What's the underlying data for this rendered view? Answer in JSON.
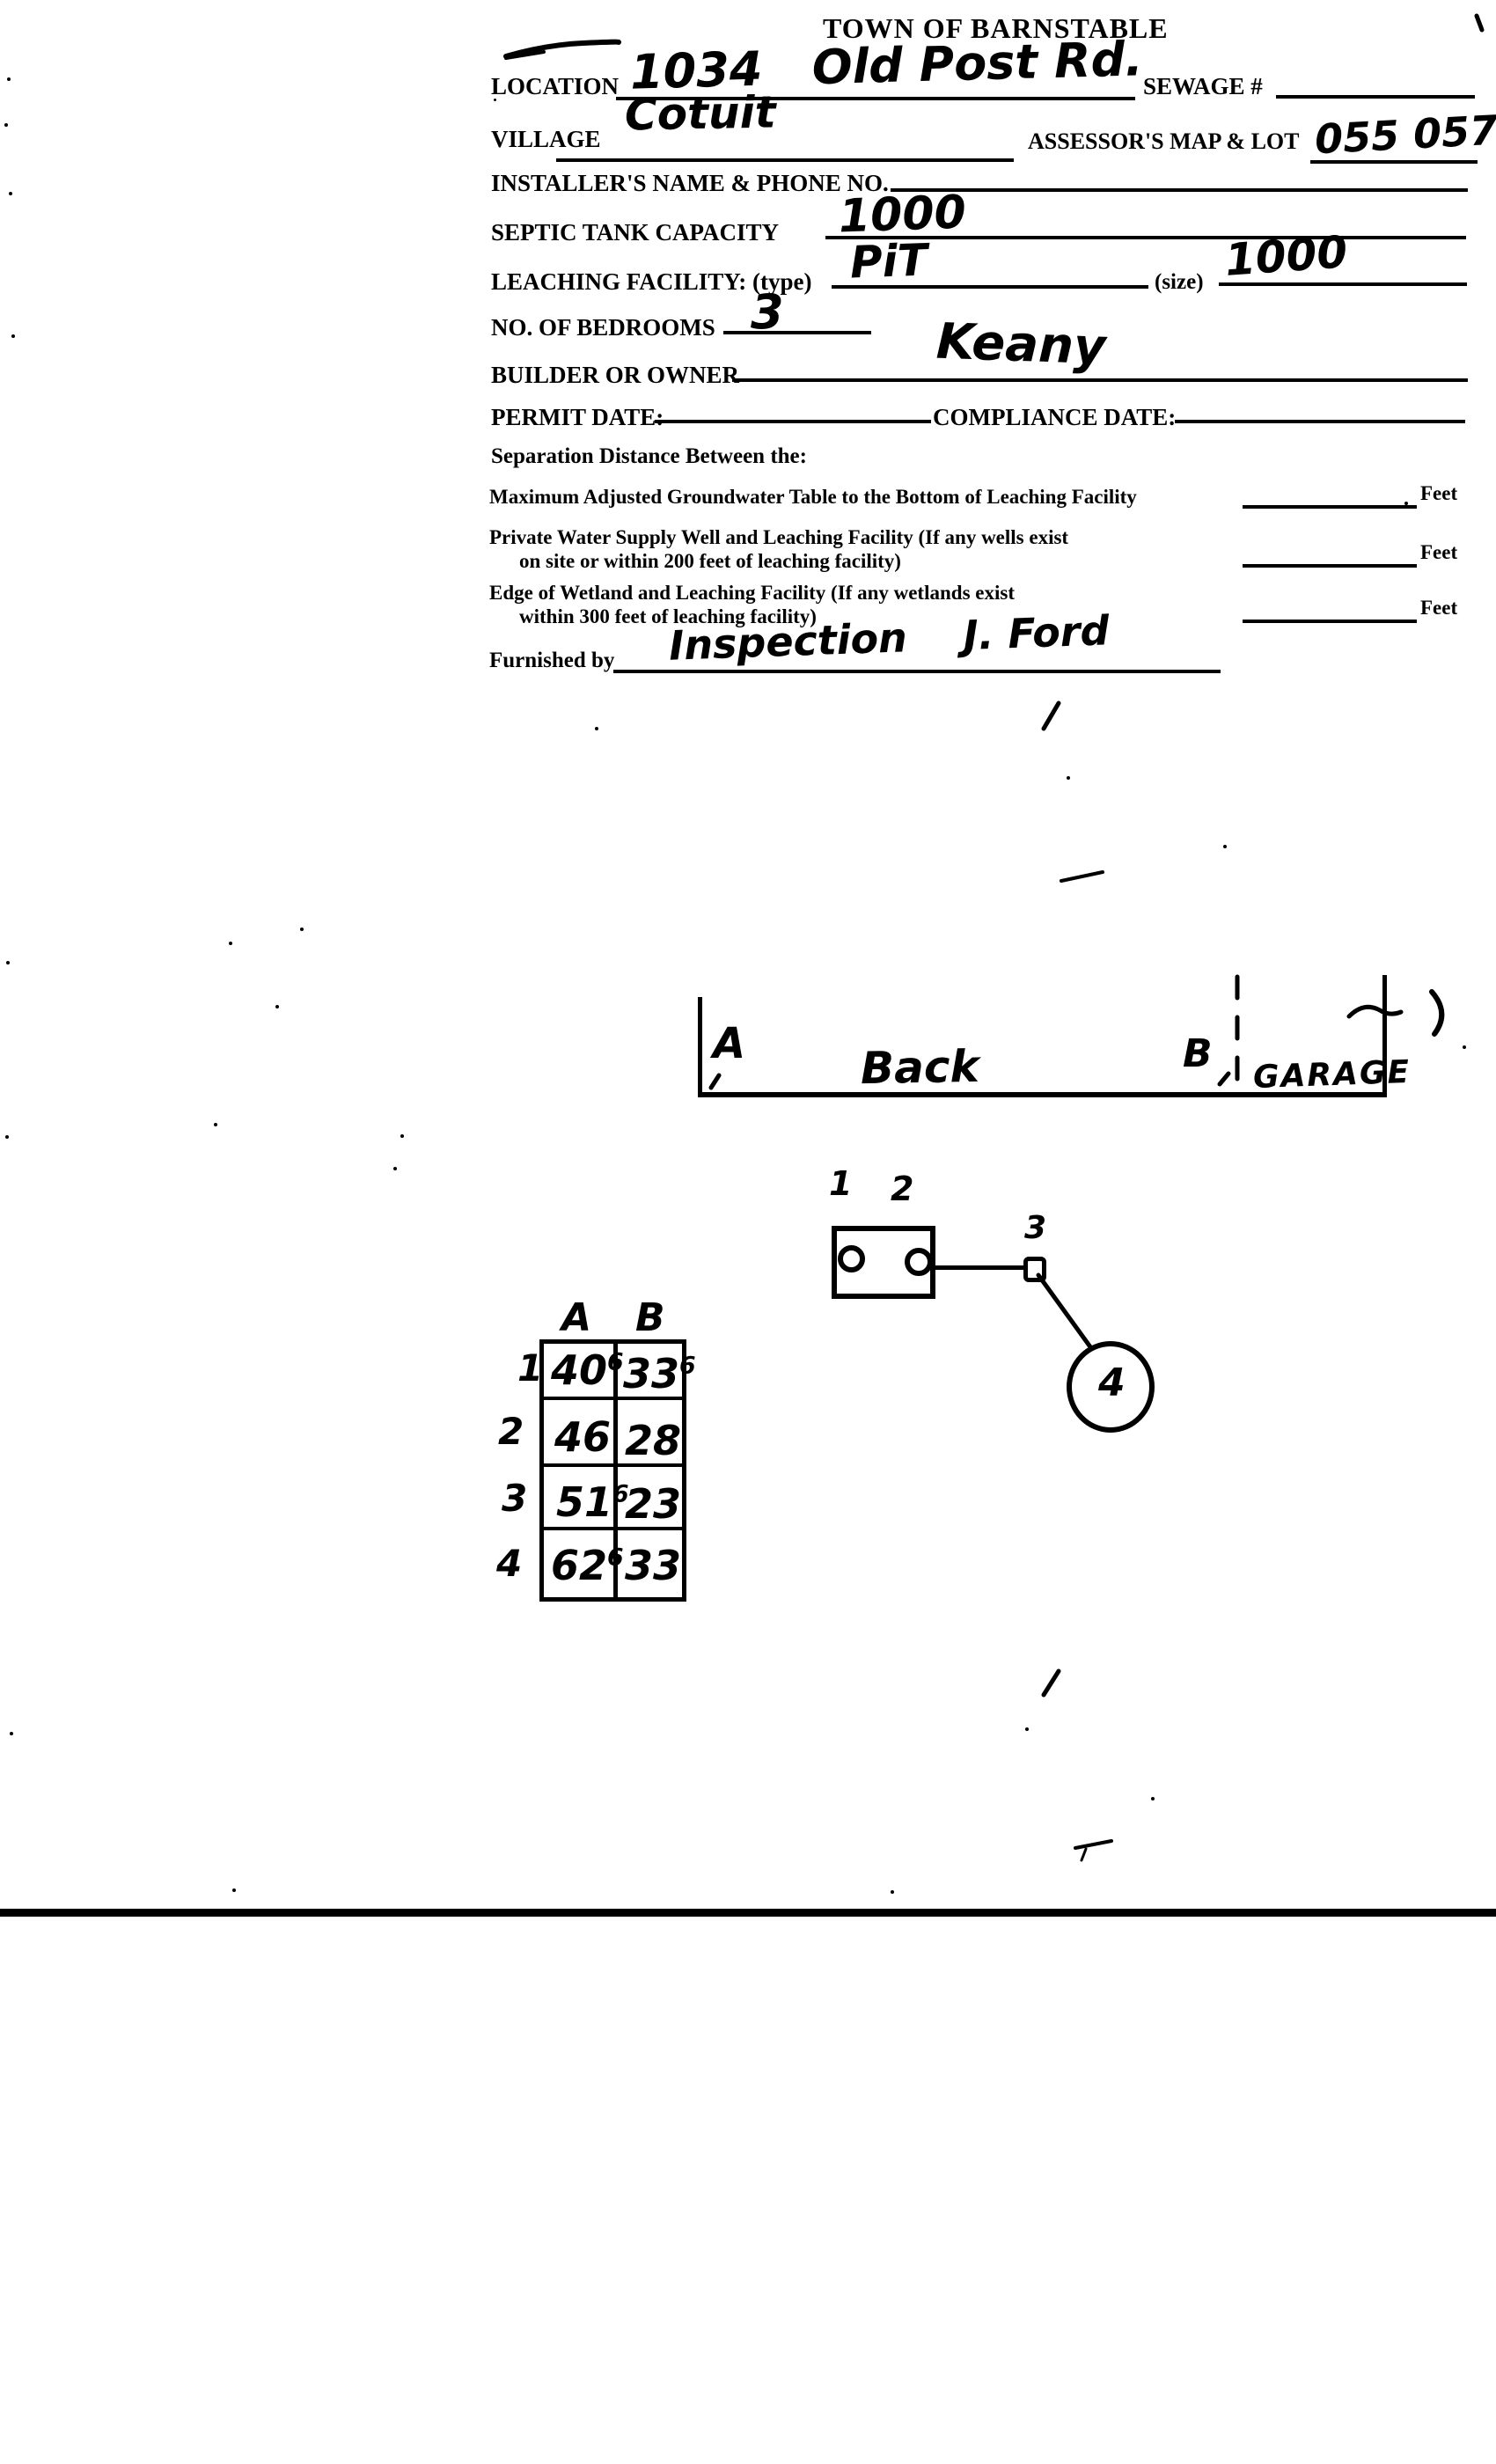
{
  "document": {
    "title": "TOWN OF BARNSTABLE",
    "fields": {
      "location": {
        "label": "LOCATION",
        "value": "1034   Old Post Rd."
      },
      "sewage": {
        "label": "SEWAGE #",
        "value": ""
      },
      "village": {
        "label": "VILLAGE",
        "value": "Cotuit"
      },
      "assessors_map_lot": {
        "label": "ASSESSOR'S MAP & LOT",
        "value": "055 057"
      },
      "installer": {
        "label": "INSTALLER'S NAME & PHONE NO.",
        "value": ""
      },
      "septic_tank_capacity": {
        "label": "SEPTIC TANK CAPACITY",
        "value": "1000"
      },
      "leaching_facility": {
        "label": "LEACHING FACILITY: (type)",
        "type_value": "PiT",
        "size_label": "(size)",
        "size_value": "1000"
      },
      "bedrooms": {
        "label": "NO. OF BEDROOMS",
        "value": "3"
      },
      "builder_or_owner": {
        "label": "BUILDER OR OWNER",
        "value": "Keany"
      },
      "permit_date": {
        "label": "PERMIT DATE:",
        "value": ""
      },
      "compliance_date": {
        "label": "COMPLIANCE DATE:",
        "value": ""
      }
    },
    "separation": {
      "heading": "Separation Distance Between the:",
      "rows": [
        {
          "line1": "Maximum Adjusted Groundwater Table to the Bottom of Leaching Facility",
          "line2": "",
          "unit": "Feet",
          "value": ""
        },
        {
          "line1": "Private Water Supply Well and Leaching Facility  (If any wells exist",
          "line2": "on site or within 200 feet of leaching facility)",
          "unit": "Feet",
          "value": ""
        },
        {
          "line1": "Edge of Wetland and Leaching Facility (If any wetlands exist",
          "line2": "within 300 feet of leaching facility)",
          "unit": "Feet",
          "value": ""
        }
      ]
    },
    "furnished_by": {
      "label": "Furnished by",
      "value": "Inspection    J. Ford"
    }
  },
  "site_sketch": {
    "point_a": "A",
    "point_b": "B",
    "back_label": "Back",
    "garage_label": "GARAGE"
  },
  "system_diagram": {
    "tank_port_1": "1",
    "tank_port_2": "2",
    "distribution_box": "3",
    "leach_pit": "4"
  },
  "measurements": {
    "type": "table",
    "columns": [
      "A",
      "B"
    ],
    "rows": [
      {
        "point": "1",
        "a": "40",
        "a_sup": "6",
        "b": "33",
        "b_sup": "6"
      },
      {
        "point": "2",
        "a": "46",
        "a_sup": "",
        "b": "28",
        "b_sup": ""
      },
      {
        "point": "3",
        "a": "51",
        "a_sup": "6",
        "b": "23",
        "b_sup": ""
      },
      {
        "point": "4",
        "a": "62",
        "a_sup": "6",
        "b": "33",
        "b_sup": ""
      }
    ]
  }
}
